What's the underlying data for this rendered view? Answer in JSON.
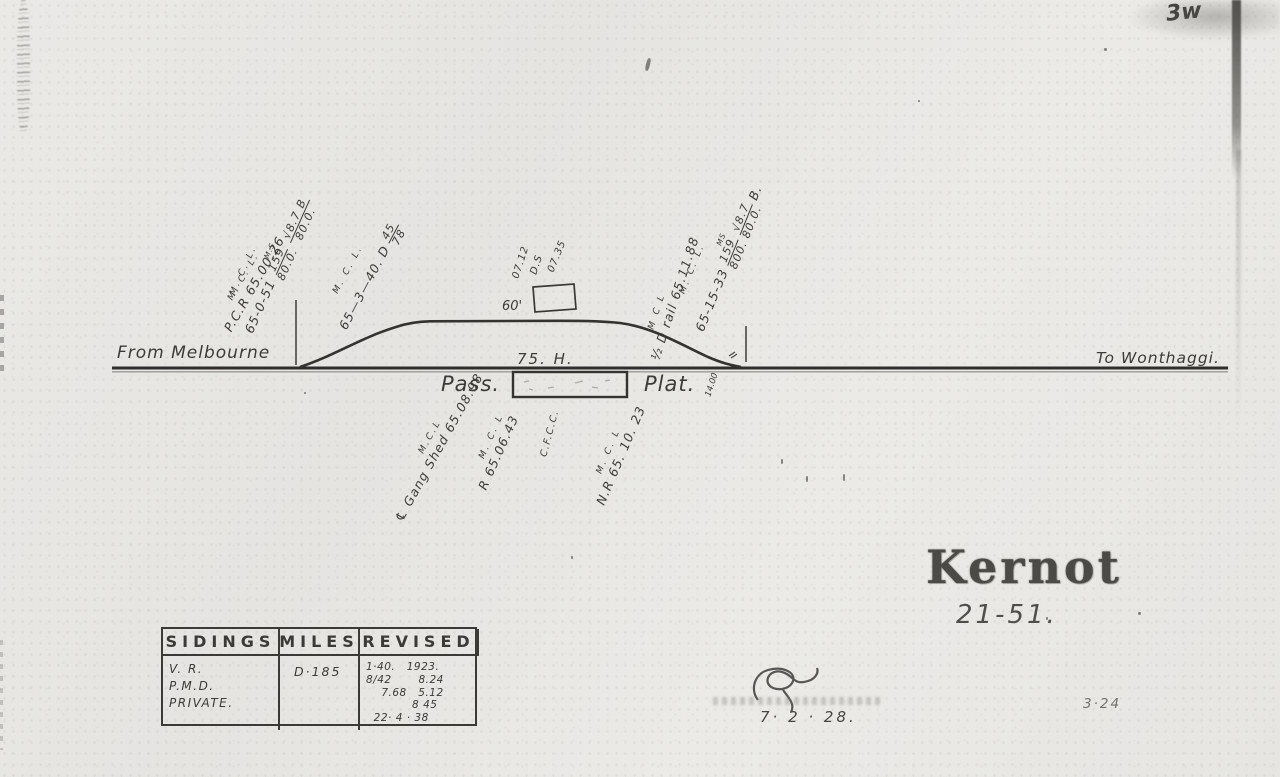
{
  "corner_mark": "3w",
  "line_labels": {
    "from": "From Melbourne",
    "to": "To Wonthaggi."
  },
  "loop": {
    "label": "75. H.",
    "junction_mile": "14.00"
  },
  "platform": {
    "pass": "Pass.",
    "plat": "Plat."
  },
  "annotations": {
    "pcr": {
      "l1": "M. C. L.",
      "l2": "P.C.R 65.00.26"
    },
    "pts_left": {
      "l1": "M. C. L.",
      "mile": "65-0-51",
      "sup": "M.S.",
      "frac_n": "159",
      "frac_d": "80.0.",
      "chk_n": "√8.7 B",
      "chk_d": "80.0."
    },
    "grade_40": {
      "l1": "M. C. L.",
      "mile": "65—3—40.",
      "d": "D",
      "frac_n": "45",
      "frac_d": "78"
    },
    "shed": {
      "t1": "07.12",
      "t2": "D.S",
      "t3": "07.35",
      "size": "60'"
    },
    "d_rail": {
      "l1": "M C L",
      "l2": "½ D rail 65.11.88"
    },
    "pts_right": {
      "l1": "M. C. L.",
      "mile": "65-15-33",
      "sup": "MS",
      "frac_n": "159",
      "frac_d": "800.",
      "chk_n": "√8.7",
      "chk_d": "80.0.",
      "tail": "B."
    },
    "gang_shed": {
      "sup": "M.C.L",
      "text": "℄ Gang Shed 65.08.98"
    },
    "r_mark": {
      "l1": "M. C. L",
      "l2": "R 65.06.43"
    },
    "cfcc": "C.F.C.C.",
    "nr_mark": {
      "l1": "M. C. L",
      "l2": "N.R 65. 10. 23"
    }
  },
  "title": {
    "name": "Kernot",
    "number": "21-51."
  },
  "table": {
    "headers": [
      "SIDINGS",
      "MILES",
      "REVISED"
    ],
    "sidings": [
      "V. R.",
      "P.M.D.",
      "PRIVATE."
    ],
    "miles": "D·185",
    "revised": [
      "1·40.   1923.",
      "8/42       8.24",
      "    7.68   5.12",
      "            8 45",
      "  22· 4 · 38"
    ]
  },
  "footer": {
    "date": "7·  2 · 28.",
    "sheet": "3·24"
  }
}
